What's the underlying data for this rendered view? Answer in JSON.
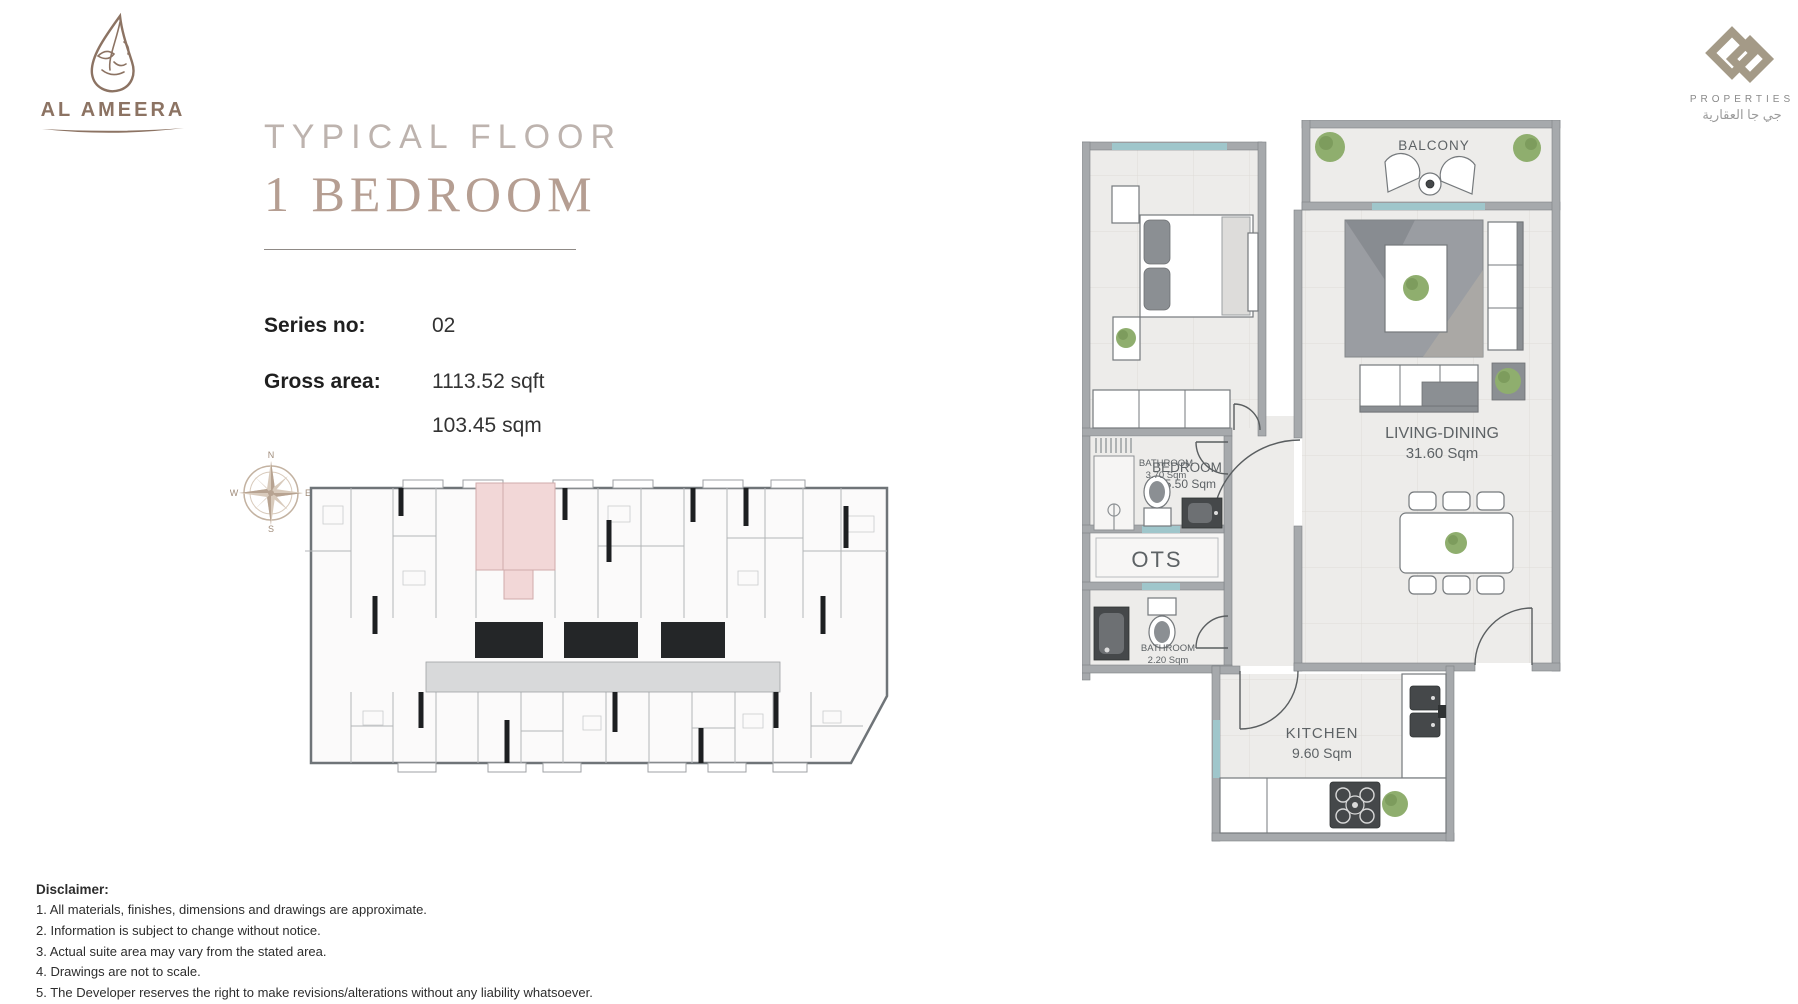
{
  "brand": {
    "left_logo_text": "AL AMEERA",
    "right_logo_text": "PROPERTIES",
    "right_logo_arabic": "جي جا العقارية"
  },
  "title": {
    "line1": "TYPICAL FLOOR",
    "line2": "1 BEDROOM"
  },
  "specs": {
    "series_label": "Series no:",
    "series_value": "02",
    "area_label": "Gross area:",
    "area_sqft": "1113.52 sqft",
    "area_sqm": "103.45 sqm"
  },
  "compass": {
    "n": "N",
    "e": "E",
    "s": "S",
    "w": "W"
  },
  "detail_plan": {
    "balcony_label": "BALCONY",
    "bedroom_label": "BEDROOM",
    "bedroom_area": "15.50 Sqm",
    "living_label": "LIVING-DINING",
    "living_area": "31.60 Sqm",
    "bathroom1_label": "BATHROOM",
    "bathroom1_area": "3.70 Sqm",
    "ots_label": "OTS",
    "bathroom2_label": "BATHROOM",
    "bathroom2_area": "2.20 Sqm",
    "kitchen_label": "KITCHEN",
    "kitchen_area": "9.60 Sqm"
  },
  "disclaimer": {
    "heading": "Disclaimer:",
    "items": [
      "1. All materials, finishes, dimensions and drawings are approximate.",
      "2. Information is subject to change without notice.",
      "3. Actual suite area may vary from the stated area.",
      "4. Drawings are not to scale.",
      "5. The Developer reserves the right to make revisions/alterations without any liability whatsoever."
    ]
  },
  "colors": {
    "brand_brown": "#8c7363",
    "brand_taupe": "#a49a87",
    "title_gray": "#bdb3ae",
    "title_serif": "#b59e92",
    "highlight_pink": "#f2d7d7",
    "window_teal": "#9fc6cb",
    "wall_gray": "#a6a9ac",
    "plant_green": "#8fae6e",
    "floor_tone": "#edecea"
  }
}
